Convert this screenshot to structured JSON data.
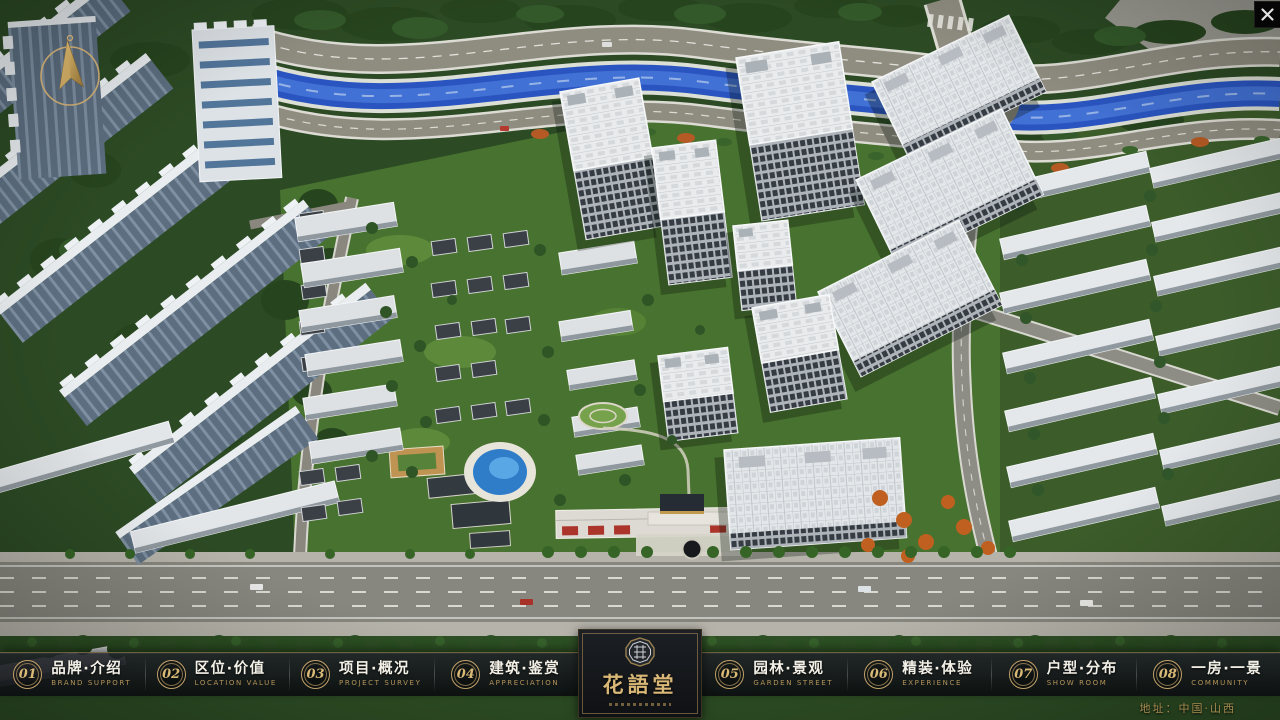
{
  "nav": {
    "items": [
      {
        "num": "01",
        "label": "品牌·介绍",
        "sub": "BRAND SUPPORT"
      },
      {
        "num": "02",
        "label": "区位·价值",
        "sub": "LOCATION VALUE"
      },
      {
        "num": "03",
        "label": "项目·概况",
        "sub": "PROJECT SURVEY"
      },
      {
        "num": "04",
        "label": "建筑·鉴赏",
        "sub": "APPRECIATION"
      },
      {
        "num": "05",
        "label": "园林·景观",
        "sub": "GARDEN STREET"
      },
      {
        "num": "06",
        "label": "精装·体验",
        "sub": "EXPERIENCE"
      },
      {
        "num": "07",
        "label": "户型·分布",
        "sub": "SHOW ROOM"
      },
      {
        "num": "08",
        "label": "一房·一景",
        "sub": "COMMUNITY"
      }
    ]
  },
  "logo": {
    "title": "花語堂"
  },
  "footer": {
    "address": "地址：中国·山西"
  },
  "colors": {
    "gold": "#c9a96a",
    "river": "#2a55c0",
    "bar": "#14171b"
  }
}
